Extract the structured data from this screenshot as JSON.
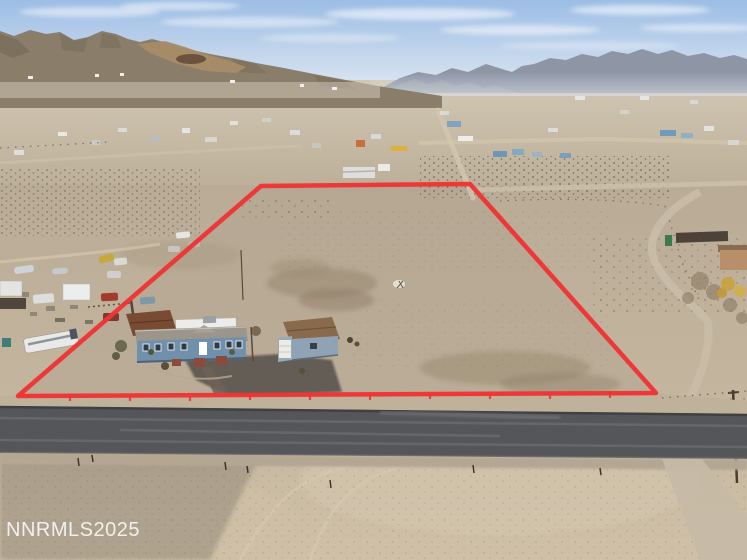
{
  "watermark": {
    "text": "NNRMLS2025"
  },
  "scene": {
    "type": "aerial drone photograph",
    "subject": "vacant high-desert land parcel outlined in red, with a blue manufactured home, detached garage, RV and scattered vehicles at its lower-left corner; paved two-lane road across the foreground; rural desert valley with scattered homes, trailers and dirt roads in the midground; brown mountain range left and hazy blue mountain range right under a pale blue sky with thin clouds",
    "boundary": {
      "points": "261,186 470,184 656,393 18,396",
      "style": "solid red surveyor outline with small tick marks along the road frontage"
    },
    "objects": [
      {
        "name": "property-boundary",
        "color": "#ee3333"
      },
      {
        "name": "main-house",
        "color": "#7190ac",
        "note": "blue siding, white trim, central steps"
      },
      {
        "name": "garage",
        "color": "#97aaba",
        "note": "brown shingle roof, white door"
      },
      {
        "name": "barn-shed",
        "color": "#7a4b33"
      },
      {
        "name": "rv-motorhome",
        "color": "#e9e9e7"
      },
      {
        "name": "paved-road",
        "color": "#54565a"
      },
      {
        "name": "desert-ground",
        "color": "#c0b29c"
      },
      {
        "name": "left-mountains",
        "color": "#8a7d69"
      },
      {
        "name": "right-mountains",
        "color": "#8e96a6"
      },
      {
        "name": "sky",
        "color": "#9cbde5"
      }
    ]
  },
  "colors": {
    "sky_top": "#9cbde5",
    "sky_horizon": "#e4ecf5",
    "cloud": "#ffffff",
    "mountain_left": "#8a7d69",
    "mountain_left_shadow": "#6e6354",
    "bald_hill": "#a78c68",
    "bald_hill_dark": "#5c4433",
    "mountain_mid": "#9aa1ad",
    "mountain_right": "#8e96a6",
    "valley_floor": "#c0b29c",
    "terrain_mid": "#b9ab97",
    "terrain_light": "#cbbca4",
    "sand_light": "#d5c7ae",
    "dark_patch": "#93836c",
    "scrub_dot": "#574f44",
    "road_asphalt": "#54565a",
    "road_edge": "#3e4043",
    "road_streak": "#74767a",
    "shoulder": "#c0b19b",
    "dirt_road": "#c6b9a5",
    "boundary_red": "#ee3333",
    "house_wall": "#7190ac",
    "house_roof": "#9c958b",
    "house_trim": "#ffffff",
    "porch_steps": "#8c4a3a",
    "barn_roof": "#7a4b33",
    "garage_roof": "#8a6a4c",
    "garage_wall": "#97aaba",
    "garage_door": "#edebe6",
    "rv_white": "#e9e9e7",
    "watermark": "#f5f5f5"
  }
}
